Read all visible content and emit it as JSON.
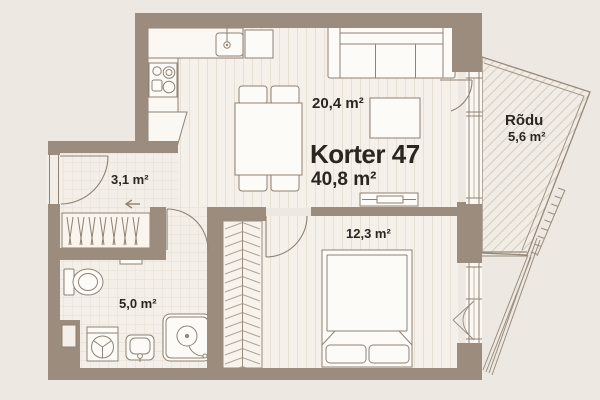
{
  "plan": {
    "title": "Korter 47",
    "total_area": "40,8 m²",
    "rooms": {
      "living": {
        "area": "20,4 m²"
      },
      "hall": {
        "area": "3,1 m²"
      },
      "bathroom": {
        "area": "5,0 m²"
      },
      "bedroom": {
        "area": "12,3 m²"
      },
      "balcony": {
        "name": "Rõdu",
        "area": "5,6 m²"
      }
    },
    "colors": {
      "wall": "#9C8C7D",
      "floor": "#F5F0E9",
      "background": "#EDE9E2",
      "line": "#8F8173",
      "text": "#2B2620"
    }
  }
}
